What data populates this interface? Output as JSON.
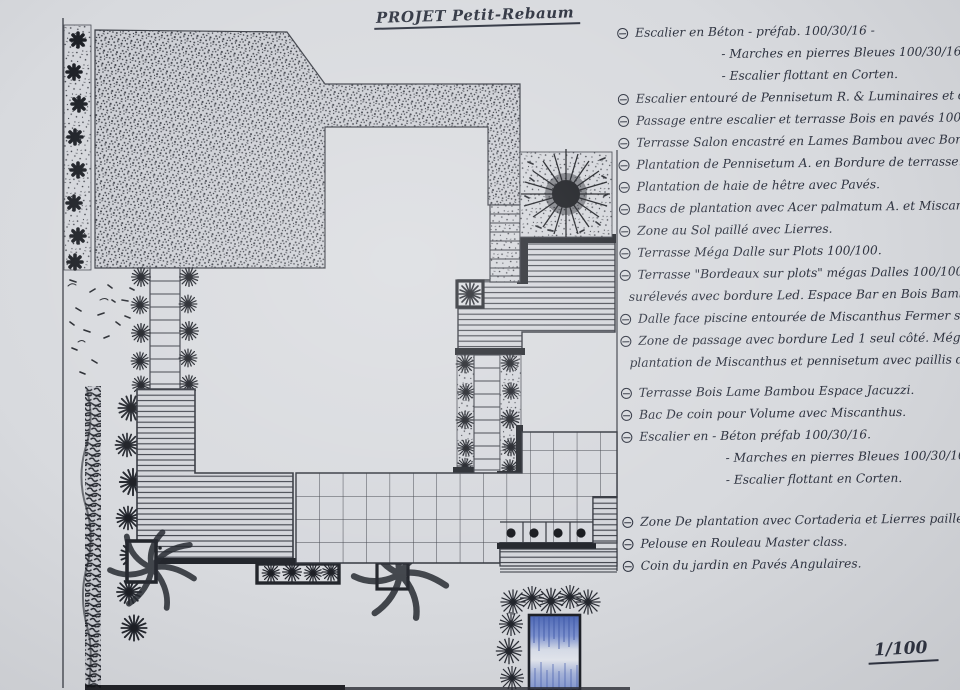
{
  "document": {
    "title": "PROJET Petit-Rebaum",
    "scale_label": "1/100"
  },
  "colors": {
    "ink": "#2e3340",
    "paper": "#d8dade",
    "thick_border": "#23262c",
    "pool_blue": "#5f7ac6"
  },
  "notes": {
    "bullet_style": "circled-dash",
    "items": [
      {
        "text": "Escalier en Béton - préfab. 100/30/16 -",
        "indent": 0
      },
      {
        "text": "- Marches en pierres Bleues 100/30/16.",
        "indent": 2
      },
      {
        "text": "- Escalier flottant en Corten.",
        "indent": 2
      },
      {
        "text": "Escalier entouré de Pennisetum R. & Luminaires et dalles de Liais",
        "indent": 0
      },
      {
        "text": "Passage entre escalier et terrasse Bois en pavés 100/100.",
        "indent": 0
      },
      {
        "text": "Terrasse Salon encastré en Lames Bambou avec Bordures Led",
        "indent": 0
      },
      {
        "text": "Plantation de Pennisetum A. en Bordure de terrasse.",
        "indent": 0
      },
      {
        "text": "Plantation de haie de hêtre avec Pavés.",
        "indent": 0
      },
      {
        "text": "Bacs de plantation avec Acer palmatum A. et Miscanthus G.",
        "indent": 0
      },
      {
        "text": "Zone au Sol paillé avec Lierres.",
        "indent": 0
      },
      {
        "text": "Terrasse Méga Dalle sur Plots 100/100.",
        "indent": 0
      },
      {
        "text": "Terrasse \"Bordeaux sur plots\" mégas Dalles 100/100 sur plots",
        "indent": 0
      },
      {
        "text": "surélevés avec bordure Led. Espace Bar en Bois Bambou",
        "indent": 1
      },
      {
        "text": "Dalle face piscine entourée de Miscanthus Fermer ses côtés",
        "indent": 0
      },
      {
        "text": "Zone de passage avec bordure Led 1 seul côté. Mégas dalles.",
        "indent": 0
      },
      {
        "text": "plantation de Miscanthus et pennisetum avec paillis de Schiste",
        "indent": 1
      },
      {
        "text": "Terrasse Bois Lame Bambou Espace Jacuzzi.",
        "indent": 0,
        "gap": "m"
      },
      {
        "text": "Bac De coin pour Volume avec Miscanthus.",
        "indent": 0
      },
      {
        "text": "Escalier en - Béton préfab 100/30/16.",
        "indent": 0
      },
      {
        "text": "- Marches en pierres Bleues 100/30/100.",
        "indent": 2
      },
      {
        "text": "- Escalier flottant en Corten.",
        "indent": 2
      },
      {
        "text": "Zone De plantation avec Cortaderia et Lierres paillés.",
        "indent": 0,
        "gap": "l"
      },
      {
        "text": "Pelouse en Rouleau Master class.",
        "indent": 0
      },
      {
        "text": "Coin du jardin en Pavés Angulaires.",
        "indent": 0
      }
    ]
  }
}
